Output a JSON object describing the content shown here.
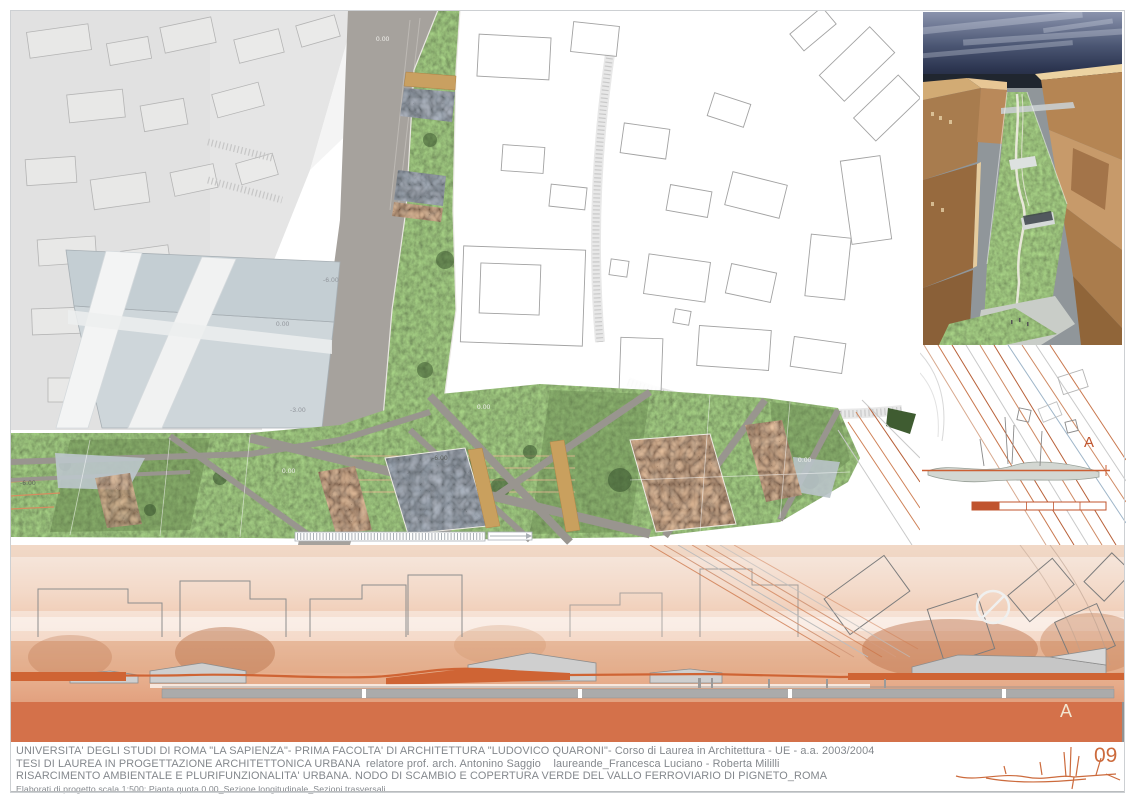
{
  "colors": {
    "accent_orange": "#d4714a",
    "section_orange": "#cc5f33",
    "sketch_orange": "#cc6b3d",
    "text_gray": "#84888d",
    "grass_green": "#4c6a39",
    "glass_blue": "#c4ced3",
    "road_gray": "#a6a29d"
  },
  "title_block": {
    "line1": "UNIVERSITA' DEGLI STUDI DI ROMA \"LA SAPIENZA\"- PRIMA FACOLTA' DI ARCHITETTURA \"LUDOVICO QUARONI\"- Corso di Laurea in Architettura - UE - a.a. 2003/2004",
    "line2": "TESI DI LAUREA IN PROGETTAZIONE ARCHITETTONICA URBANA  relatore prof. arch. Antonino Saggio    laureande_Francesca Luciano - Roberta Mililli",
    "line3": "RISARCIMENTO AMBIENTALE E PLURIFUNZIONALITA' URBANA. NODO DI SCAMBIO E COPERTURA VERDE DEL VALLO FERROVIARIO DI PIGNETO_ROMA",
    "line4": "Elaborati di progetto scala 1:500: Pianta quota 0.00_Sezione longitudinale_Sezioni trasversali"
  },
  "sheet_number": "09",
  "section_marks": {
    "band_label": "A",
    "profile_label": "A"
  },
  "plan": {
    "elevation_labels": [
      {
        "text": "0.00",
        "x": 376,
        "y": 36,
        "tone": "white"
      },
      {
        "text": "-6.00",
        "x": 323,
        "y": 277,
        "tone": "gray"
      },
      {
        "text": "0.00",
        "x": 276,
        "y": 321,
        "tone": "gray"
      },
      {
        "text": "-3.00",
        "x": 290,
        "y": 407,
        "tone": "gray"
      },
      {
        "text": "-6.00",
        "x": 20,
        "y": 480,
        "tone": "dark"
      },
      {
        "text": "0.00",
        "x": 282,
        "y": 468,
        "tone": "white"
      },
      {
        "text": "-6.00",
        "x": 432,
        "y": 455,
        "tone": "dark"
      },
      {
        "text": "0.00",
        "x": 477,
        "y": 404,
        "tone": "white"
      },
      {
        "text": "0.00",
        "x": 798,
        "y": 457,
        "tone": "white"
      }
    ]
  }
}
